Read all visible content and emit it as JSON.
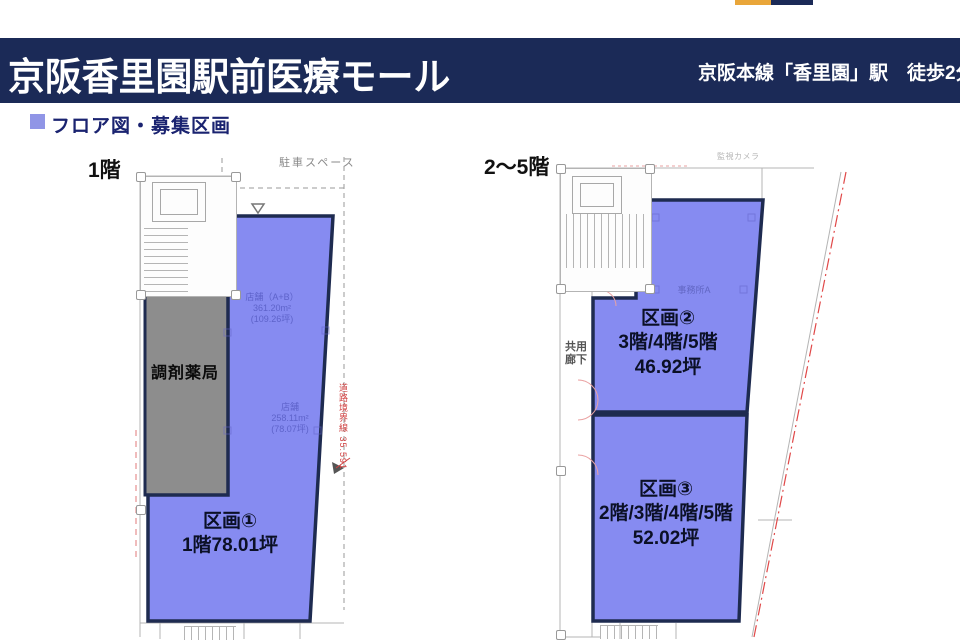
{
  "header": {
    "title": "京阪香里園駅前医療モール",
    "station_note": "京阪本線「香里園」駅　徒歩2分"
  },
  "section_heading": {
    "label": "フロア図・募集区画"
  },
  "plans": {
    "left": {
      "floor_label": "1階",
      "parking_label": "駐車スペース",
      "pharmacy_label": "調剤薬局",
      "unit1_name": "区画①",
      "unit1_area": "1階78.01坪",
      "faint_upper": [
        "店舗（A+B）",
        "361.20m²",
        "(109.26坪)"
      ],
      "faint_lower": [
        "店舗",
        "258.11m²",
        "(78.07坪)"
      ],
      "boundary_note": "道路境界線 35.591"
    },
    "right": {
      "floor_label": "2〜5階",
      "corridor_label": [
        "共用",
        "廊下"
      ],
      "office_note": "事務所A",
      "corner_note": "監視カメラ",
      "unit2_name": "区画②",
      "unit2_floors": "3階/4階/5階",
      "unit2_area": "46.92坪",
      "unit3_name": "区画③",
      "unit3_floors": "2階/3階/4階/5階",
      "unit3_area": "52.02坪"
    }
  },
  "colors": {
    "header_bg": "#1b2a57",
    "logo_orange": "#e9a63a",
    "heading_text": "#1a2370",
    "heading_bullet": "#9095e6",
    "zone_fill": "#7d82f0",
    "zone_border": "#1e2b50",
    "pharmacy_fill": "#8d8d8d",
    "plan_line": "#b4b4b4",
    "boundary_red": "#d94040"
  }
}
